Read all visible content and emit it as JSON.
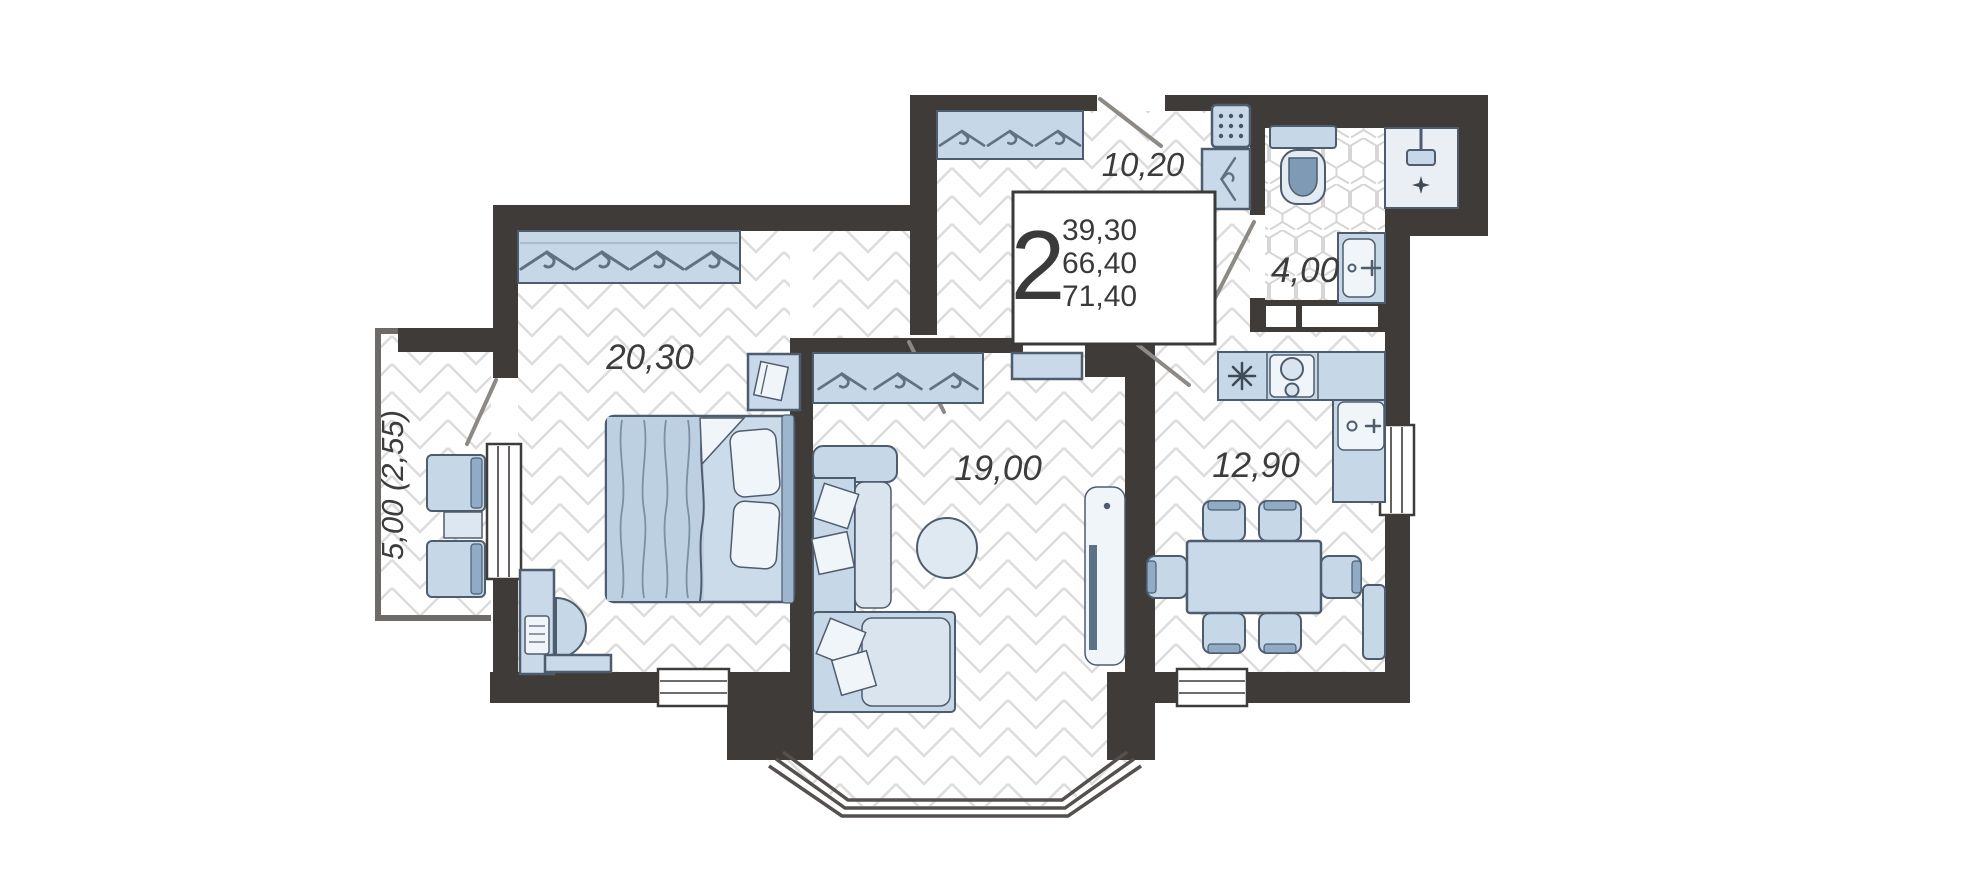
{
  "info_box": {
    "rooms_count": "2",
    "area_living": "39,30",
    "area_usable": "66,40",
    "area_total": "71,40"
  },
  "rooms": {
    "hallway": {
      "label": "10,20"
    },
    "bathroom": {
      "label": "4,00"
    },
    "bedroom": {
      "label": "20,30"
    },
    "living_room": {
      "label": "19,00"
    },
    "kitchen": {
      "label": "12,90"
    },
    "balcony": {
      "label": "5,00 (2,55)"
    }
  },
  "colors": {
    "wall": "#3f3b39",
    "furniture_fill": "#c6d7e7",
    "furniture_stroke": "#4e5d6e",
    "furniture_dark": "#8fabc6",
    "floor_line": "#dcdcdc",
    "label_text": "#3c3c3c"
  }
}
